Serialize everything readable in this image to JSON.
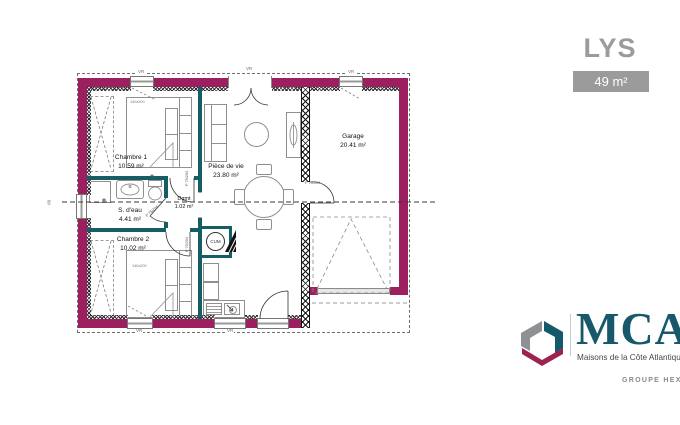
{
  "header": {
    "title": "LYS",
    "area_badge": "49 m²"
  },
  "plan": {
    "rooms": {
      "chambre1": {
        "name": "Chambre 1",
        "area": "10.59 m²"
      },
      "sdeau": {
        "name": "S. d'eau",
        "area": "4.41 m²"
      },
      "chambre2": {
        "name": "Chambre 2",
        "area": "10.02 m²"
      },
      "degagement": {
        "name": "Dgmt",
        "area": "1.02 m²"
      },
      "piece_de_vie": {
        "name": "Pièce de vie",
        "area": "23.80 m²"
      },
      "garage": {
        "name": "Garage",
        "area": "20.41 m²"
      }
    },
    "labels": {
      "cum": "CUM",
      "bed_size": "140x200",
      "door": "P 75/204",
      "shutter": "VR",
      "left_window": "60"
    }
  },
  "logo": {
    "brand": "MCA",
    "tagline": "Maisons de la Côte Atlantique",
    "group": "GROUPE HEXAOM"
  },
  "colors": {
    "exterior_wall": "#9c1f5f",
    "partition_wall": "#155e63",
    "brand_teal": "#17586b",
    "muted_gray": "#9b9b9b"
  }
}
